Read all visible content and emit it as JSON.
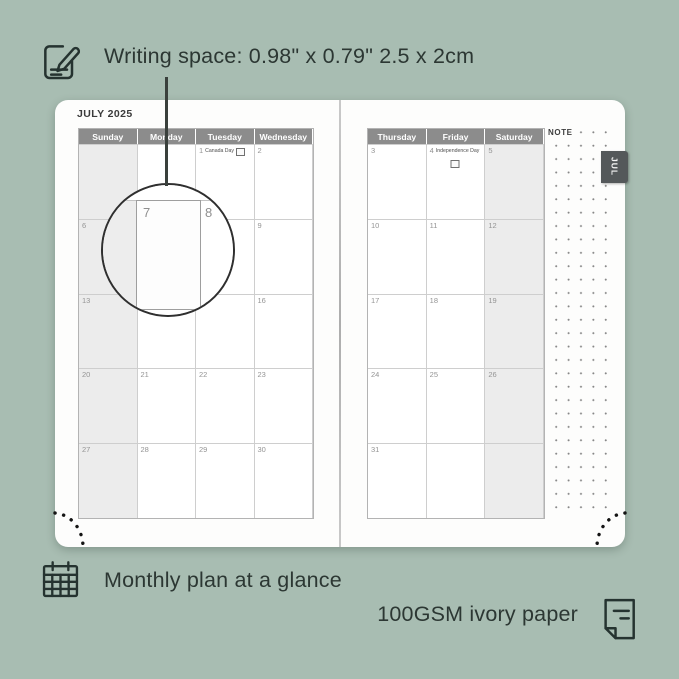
{
  "annotations": {
    "writing_space": "Writing space: 0.98\" x 0.79\" 2.5 x 2cm",
    "monthly_plan": "Monthly plan at a glance",
    "paper": "100GSM ivory paper"
  },
  "planner": {
    "month_title": "JULY 2025",
    "month_tab": "JUL",
    "note_label": "NOTE",
    "left_day_headers": [
      "Sunday",
      "Monday",
      "Tuesday",
      "Wednesday"
    ],
    "right_day_headers": [
      "Thursday",
      "Friday",
      "Saturday"
    ],
    "left_rows": [
      [
        null,
        null,
        {
          "d": "1",
          "h": "Canada Day",
          "flag": "inline"
        },
        {
          "d": "2"
        }
      ],
      [
        {
          "d": "6"
        },
        {
          "d": "7"
        },
        {
          "d": "8"
        },
        {
          "d": "9"
        }
      ],
      [
        {
          "d": "13"
        },
        {
          "d": "14",
          "h": "Orangemen's Day",
          "wrap": true
        },
        {
          "d": "15"
        },
        {
          "d": "16"
        }
      ],
      [
        {
          "d": "20"
        },
        {
          "d": "21"
        },
        {
          "d": "22"
        },
        {
          "d": "23"
        }
      ],
      [
        {
          "d": "27"
        },
        {
          "d": "28"
        },
        {
          "d": "29"
        },
        {
          "d": "30"
        }
      ]
    ],
    "right_rows": [
      [
        {
          "d": "3"
        },
        {
          "d": "4",
          "h": "Independence Day",
          "flag": "below"
        },
        {
          "d": "5"
        }
      ],
      [
        {
          "d": "10"
        },
        {
          "d": "11"
        },
        {
          "d": "12"
        }
      ],
      [
        {
          "d": "17"
        },
        {
          "d": "18"
        },
        {
          "d": "19"
        }
      ],
      [
        {
          "d": "24"
        },
        {
          "d": "25"
        },
        {
          "d": "26"
        }
      ],
      [
        {
          "d": "31"
        },
        null,
        null
      ]
    ],
    "magnifier": {
      "day": "7",
      "next_day": "8"
    }
  },
  "colors": {
    "background": "#a8bdb2",
    "ink": "#2c3733",
    "calendar_header_bg": "#8c8c8c",
    "weekend_shade": "#ececec",
    "tab_bg": "#54585a",
    "page": "#fdfdfc"
  }
}
